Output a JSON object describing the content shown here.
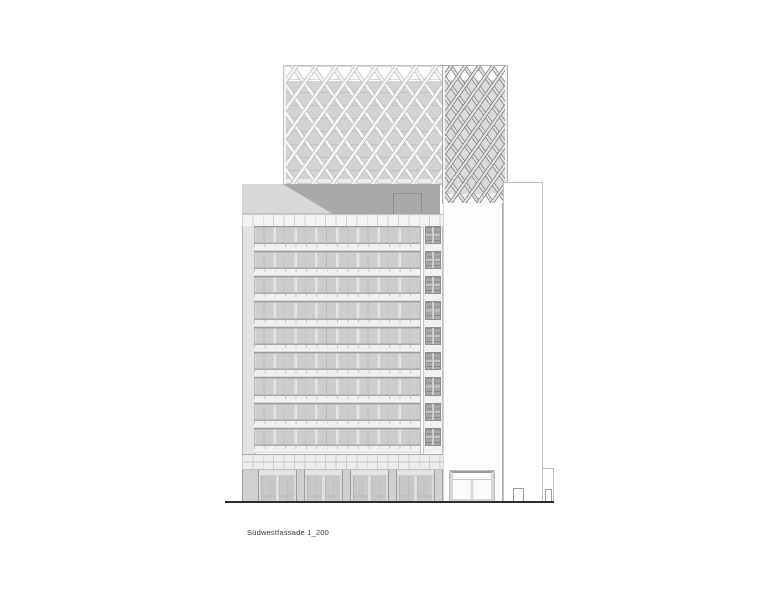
{
  "caption": {
    "label": "Südwestfassade 1_200"
  },
  "building": {
    "facade_orientation": "Südwest",
    "scale": "1_200",
    "floor_count": 9,
    "entrance_count": 4,
    "window_bays_per_floor": 8,
    "crown_sections": 2
  },
  "colors": {
    "ink": "#2d2d2d",
    "penthouse": "#a9a9a9",
    "roof-slope": "#d8d8d8",
    "window-band": "#cdcdcd",
    "spandrel": "#f0f0f0",
    "core-panel": "#a6a6a6",
    "dg-left-bg": "#d3d3d3",
    "dg-right-bg": "#dadada",
    "pier": "#d0d0d0",
    "door": "#c7c7c7",
    "caption-text": "#3b3b3b"
  }
}
